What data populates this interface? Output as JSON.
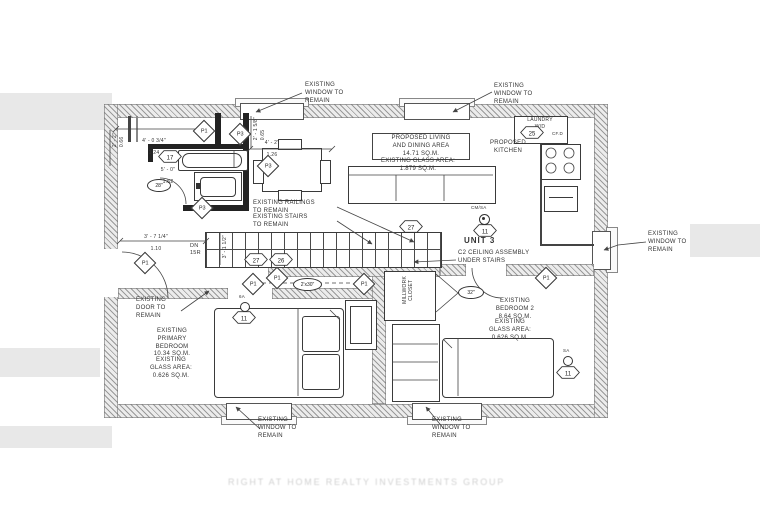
{
  "unit": {
    "label": "UNIT 3"
  },
  "callouts": {
    "window": "EXISTING\nWINDOW TO\nREMAIN",
    "door": "EXISTING\nDOOR TO\nREMAIN",
    "railings": "EXISTING RAILINGS\nTO REMAIN",
    "stairs": "EXISTING STAIRS\nTO REMAIN",
    "ceiling": "C2 CEILING ASSEMBLY\nUNDER STAIRS"
  },
  "rooms": {
    "living": {
      "title": "PROPOSED LIVING\nAND DINING AREA\n14.71 SQ.M.",
      "glass": "EXISTING GLASS AREA:\n1.879 SQ.M."
    },
    "kitchen": {
      "title": "PROPOSED\nKITCHEN"
    },
    "laundry": {
      "title": "LAUNDRY\nW/D",
      "outlet": "CF.D"
    },
    "primary_bedroom": {
      "title": "EXISTING\nPRIMARY\nBEDROOM\n10.34 SQ.M.",
      "glass": "EXISTING\nGLASS AREA:\n0.626 SQ.M."
    },
    "bedroom2": {
      "title": "EXISTING\nBEDROOM 2\n8.64 SQ.M.",
      "glass": "EXISTING\nGLASS AREA:\n0.626 SQ.M."
    },
    "closet": {
      "title": "MILLWORK\nCLOSET"
    }
  },
  "stairs": {
    "down_note": "DN\n15R"
  },
  "dimensions": {
    "bath_width": {
      "imperial": "4' - 0 3/4\"",
      "metric": "1.24"
    },
    "bath_side": {
      "imperial": "2' - 1 5/8\"",
      "metric": "0.65"
    },
    "living_edge": {
      "imperial": "4' - 2\"",
      "metric": "1.26"
    },
    "tub_wall": {
      "imperial": "5' - 0\"",
      "metric": "1.52"
    },
    "entry": {
      "imperial": "3' - 7 1/4\"",
      "metric": "1.10"
    },
    "left_wall": {
      "imperial": "2' - 2\"",
      "metric": "0.66"
    },
    "stair_width": {
      "imperial": "3' - 1 1/2\""
    }
  },
  "door_tags": {
    "bath": "28\"",
    "hall": "2'x30\"",
    "bedroom2": "32\""
  },
  "diamonds": [
    "P1",
    "P3",
    "P3",
    "P3",
    "P1",
    "P1",
    "P1",
    "P1",
    "P1"
  ],
  "hexagons": {
    "bath": "17",
    "living": "27",
    "stair_a": "27",
    "stair_b": "26",
    "laundry": "25",
    "unit": "11",
    "primary": "11",
    "bedroom2": "11"
  },
  "detectors": {
    "kitchen": "CM/SA",
    "primary": "6A",
    "bedroom2": "SA"
  },
  "watermark": "RIGHT AT HOME REALTY INVESTMENTS GROUP"
}
